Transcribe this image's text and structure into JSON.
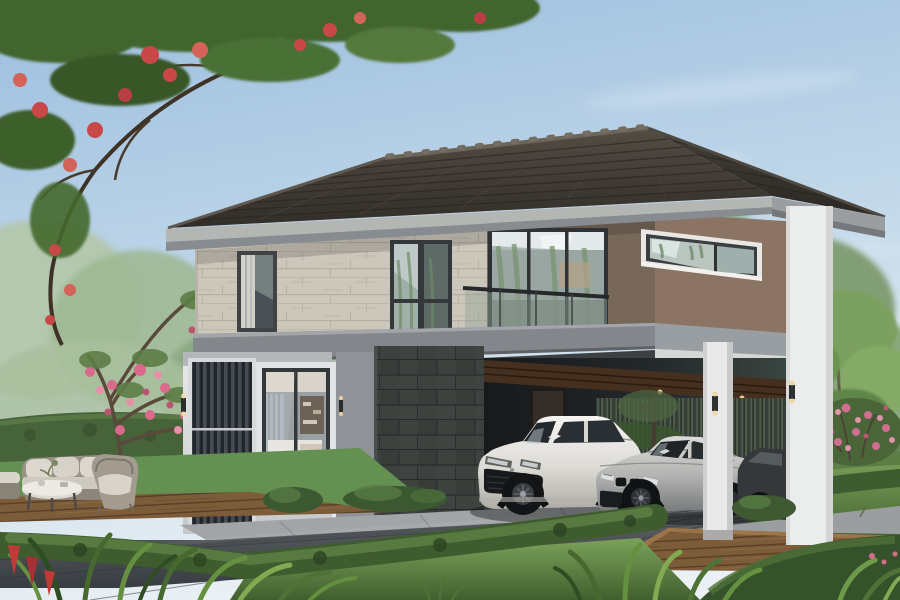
{
  "meta": {
    "title": "Modern two-story house exterior rendering",
    "type": "architectural-visualization",
    "width": 900,
    "height": 600
  },
  "scene": {
    "description": "Photorealistic daytime rendering of a modern two-story house with a dark hip tile roof, travertine and brown feature walls, a glass-railed balcony, a corner window, a vertical louver entrance screen, and an open carport sheltering a white SUV and a silver sedan. Landscaped garden with clipped hedges, lawns, a flame tree with red blossoms, a pink frangipani tree, tropical foreground plants, stone paver driveway, timber decking and a wicker outdoor lounge set.",
    "sky": {
      "condition": "clear blue with wispy clouds"
    },
    "house": {
      "stories": 2,
      "roof": "dark charcoal hip tile roof with light fascia",
      "materials": [
        "travertine stone",
        "brown wall panels",
        "white concrete",
        "charcoal slate tile",
        "glass"
      ],
      "features": [
        "glass balcony railing",
        "wrap-around corner window",
        "vertical louver screen",
        "covered carport with timber ceiling",
        "recessed downlights",
        "wall sconces"
      ]
    },
    "vehicles": [
      {
        "name": "white-suv",
        "type": "SUV",
        "color": "white"
      },
      {
        "name": "silver-sedan",
        "type": "sports sedan",
        "color": "silver"
      },
      {
        "name": "hidden-dark-car",
        "type": "partially hidden car",
        "color": "dark gray"
      }
    ],
    "landscape": [
      "flame tree with red blossoms",
      "pink frangipani tree",
      "soft willow background trees",
      "clipped box hedges",
      "lawn",
      "tropical foreground plants",
      "pink flowering shrub"
    ],
    "hardscape": [
      "stone paver driveway",
      "light concrete walkway",
      "timber deck"
    ],
    "furniture": [
      "wicker 3-seat sofa",
      "wicker armchair",
      "round coffee table",
      "ottoman"
    ]
  },
  "palette": {
    "sky_top": "#9cbede",
    "sky_mid": "#c8dcec",
    "horizon": "#eaf0f4",
    "roof_front": "#3f3a34",
    "roof_side": "#322e29",
    "roof_ridge": "#6b645a",
    "fascia": "#b4b6b4",
    "fascia_side": "#9a9ea1",
    "soffit": "#878c90",
    "soffit_side": "#74787c",
    "stone_wall": "#ccc7bb",
    "wall_brown_front": "#77685a",
    "wall_brown_side": "#8b7463",
    "slab": "#83878b",
    "slab_side": "#999ea2",
    "beam": "#d5d7d6",
    "header_shadow": "#3c4042",
    "pillar": "#ebecec",
    "column": "#e8e9e8",
    "louver_frame": "#d9dadb",
    "louver_field": "#23272a",
    "gray_wall": "#8f9397",
    "wood_ceiling": "#452f1e",
    "carport_floor": "#505456",
    "glass_dark": "#2b3034",
    "lawn": "#6a8f4c",
    "hedge": "#47633a",
    "hedge_dark": "#2e4724",
    "paving_light": "#a2a5a7",
    "paving_dark": "#43484c",
    "deck_wood": "#7d5c3a",
    "car_white": "#efeeea",
    "car_silver": "#c6c6c4",
    "car_dark": "#34383b",
    "flower_red": "#c84848",
    "flower_pink": "#d96a8b",
    "tree_green": "#547c3b",
    "tree_soft": "#a4bd97"
  }
}
